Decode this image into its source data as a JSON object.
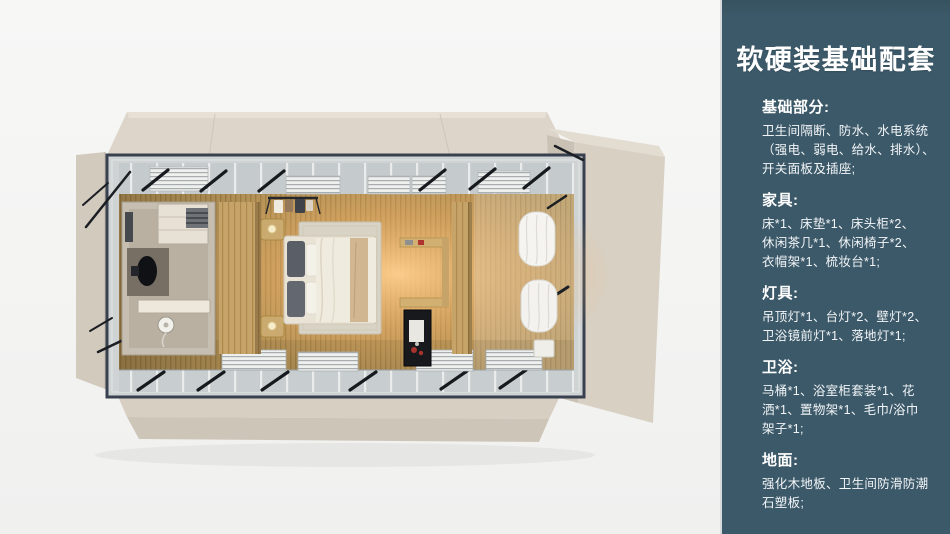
{
  "sidebar": {
    "title": "软硬装基础配套",
    "sections": [
      {
        "heading": "基础部分:",
        "body": "卫生间隔断、防水、水电系统\n（强电、弱电、给水、排水）、\n开关面板及插座;"
      },
      {
        "heading": "家具:",
        "body": "床*1、床垫*1、床头柜*2、\n休闲茶几*1、休闲椅子*2、\n衣帽架*1、梳妆台*1;"
      },
      {
        "heading": "灯具:",
        "body": "吊顶灯*1、台灯*2、壁灯*2、\n卫浴镜前灯*1、落地灯*1;"
      },
      {
        "heading": "卫浴:",
        "body": "马桶*1、浴室柜套装*1、花\n洒*1、置物架*1、毛巾/浴巾\n架子*1;"
      },
      {
        "heading": "地面:",
        "body": "强化木地板、卫生间防滑防潮\n石塑板;"
      }
    ]
  },
  "colors": {
    "sidebar_background": "#3c5969",
    "sidebar_text": "#ffffff",
    "page_background": "#f4f4f3",
    "shell_beige": "#d8d0c3",
    "steel_frame": "#394150",
    "floor_wood": "#b39257",
    "floor_glow": "#f5b469"
  }
}
